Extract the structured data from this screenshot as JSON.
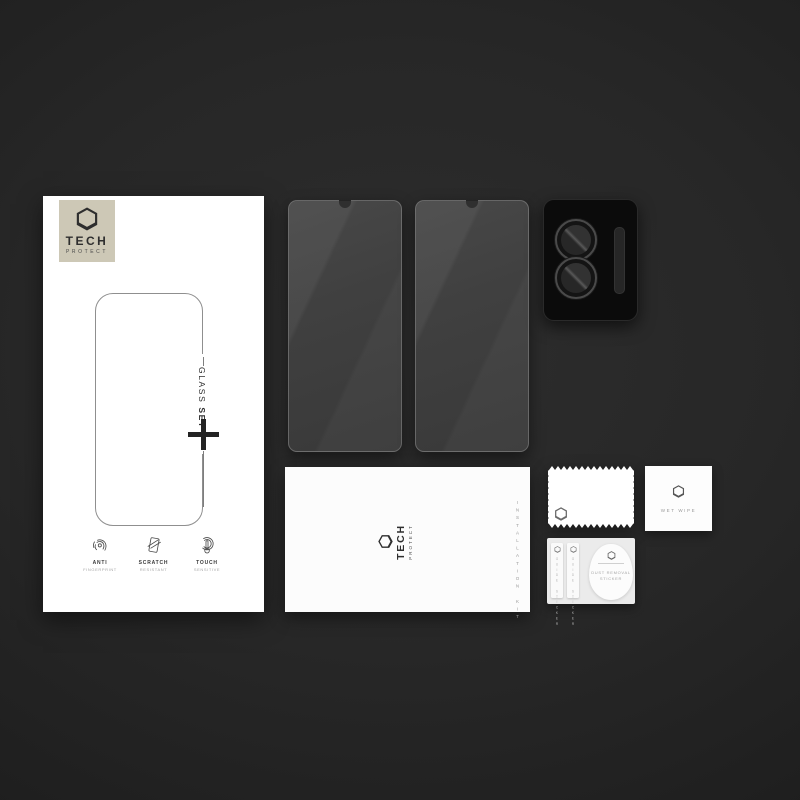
{
  "brand": {
    "line1": "TECH",
    "line2": "PROTECT"
  },
  "box": {
    "vertical_label": {
      "word1": "GLASS",
      "word2": "SET",
      "plus": "+"
    },
    "features": [
      {
        "icon": "fingerprint-icon",
        "title": "ANTI",
        "subtitle": "FINGERPRINT"
      },
      {
        "icon": "scratch-icon",
        "title": "SCRATCH",
        "subtitle": "RESISTANT"
      },
      {
        "icon": "touch-icon",
        "title": "TOUCH",
        "subtitle": "SENSITIVE"
      }
    ]
  },
  "envelope": {
    "vertical_label": "INSTALLATION KIT"
  },
  "wet_wipe": {
    "label": "WET WIPE"
  },
  "sticker_card": {
    "strip1_label": "GUIDE STICKER",
    "strip2_label": "GUIDE STICKER",
    "blob_label_line1": "DUST REMOVAL",
    "blob_label_line2": "STICKER"
  },
  "colors": {
    "background_center": "#2d2d2d",
    "background_edge": "#151515",
    "box_white": "#ffffff",
    "logo_square_beige": "#cdc8b6",
    "logo_ink": "#2e2e2e",
    "glass_gray": "#414141",
    "camera_protector_black": "#0b0b0b"
  }
}
